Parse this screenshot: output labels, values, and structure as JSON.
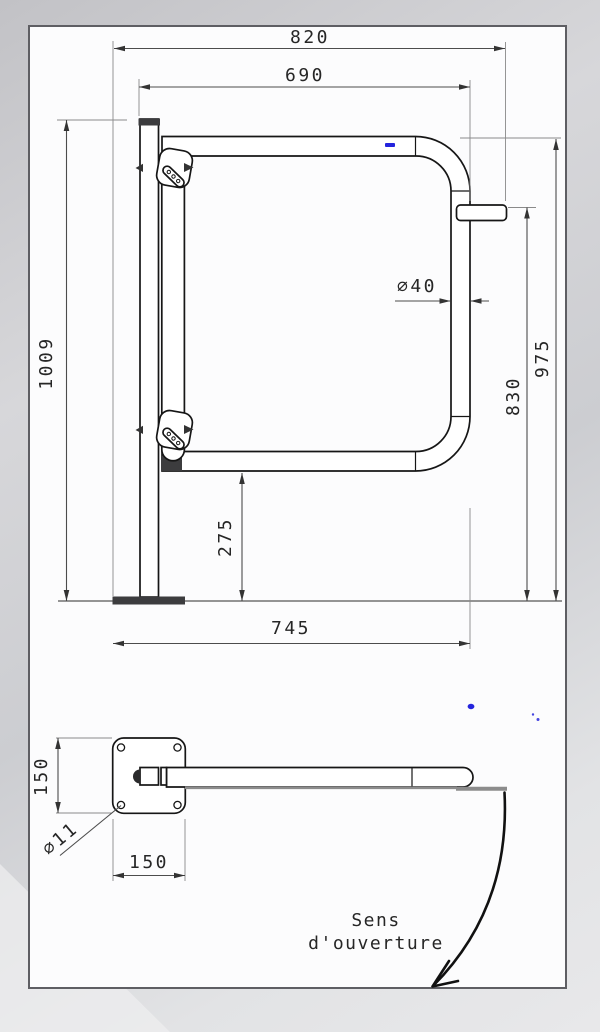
{
  "colors": {
    "paper": "#fcfcfd",
    "background_gray": "#cccdd1",
    "line_black": "#161616",
    "dimension_gray": "#4c4c4c",
    "shadow_gray": "#8c8c8c",
    "accent_blue": "#2424dd"
  },
  "elevation": {
    "dim_total_width": "820",
    "dim_gate_width": "690",
    "dim_tube_diameter": "⌀40",
    "dim_overall_height": "1009",
    "dim_height_top": "975",
    "dim_height_latch": "830",
    "dim_clearance": "275",
    "dim_base_span": "745"
  },
  "plan": {
    "dim_plate_depth": "150",
    "dim_plate_width": "150",
    "dim_hole_diameter": "⌀11",
    "opening_line1": "Sens",
    "opening_line2": "d'ouverture"
  }
}
